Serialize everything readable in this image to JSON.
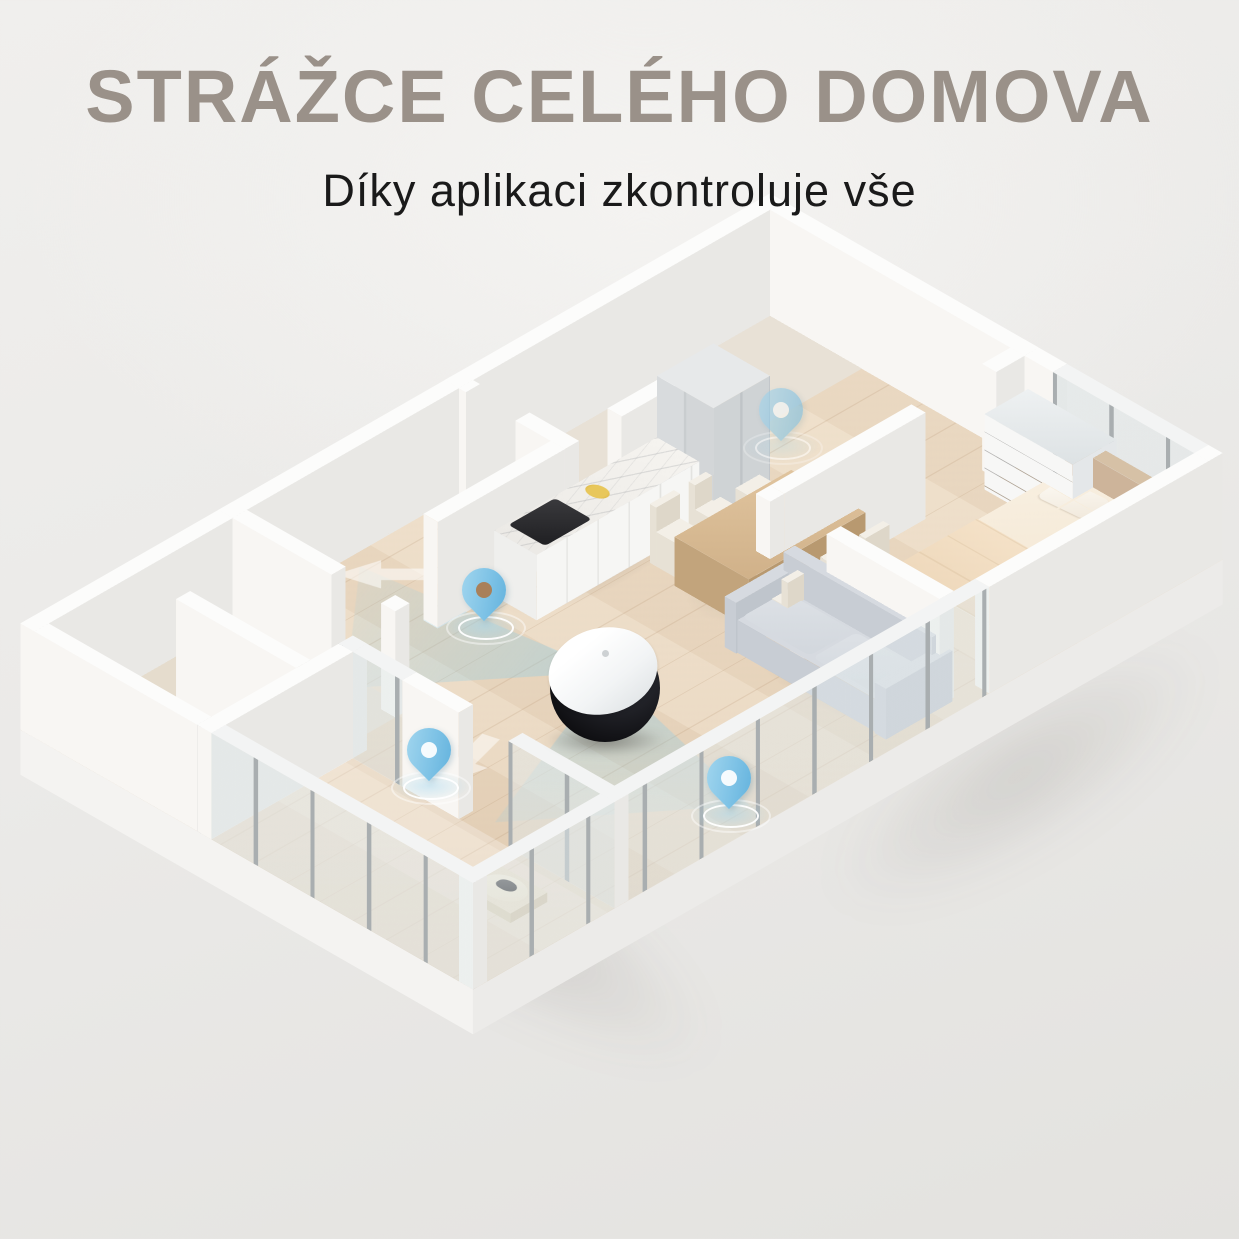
{
  "header": {
    "title": "STRÁŽCE CELÉHO DOMOVA",
    "subtitle": "Díky aplikaci zkontroluje vše"
  },
  "colors": {
    "background": "#eeedeb",
    "title_text": "#9a9189",
    "subtitle_text": "#1a1a1a",
    "accent_blue": "#7fc3e6",
    "beam": "rgba(140,205,232,0.42)",
    "wood_floor": "#ead9c3"
  },
  "scene": {
    "device": "home-security-robot-camera",
    "location_pins": [
      "hallway-pin",
      "kitchen-pin",
      "corridor-pin",
      "living-room-pin"
    ]
  }
}
